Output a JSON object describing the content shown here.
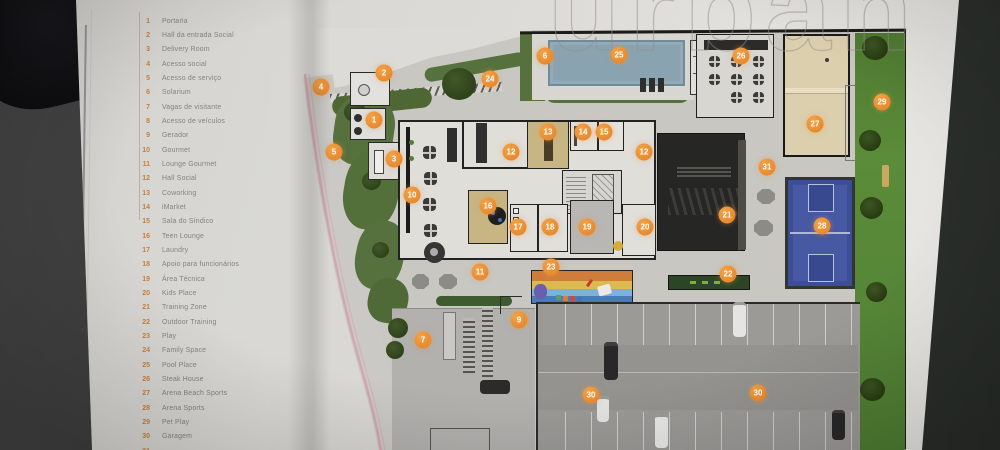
{
  "page": {
    "watermark": "urban"
  },
  "legend": {
    "items": [
      {
        "num": "1",
        "label": "Portaria"
      },
      {
        "num": "2",
        "label": "Hall da entrada Social"
      },
      {
        "num": "3",
        "label": "Delivery Room"
      },
      {
        "num": "4",
        "label": "Acesso social"
      },
      {
        "num": "5",
        "label": "Acesso de serviço"
      },
      {
        "num": "6",
        "label": "Solarium"
      },
      {
        "num": "7",
        "label": "Vagas de visitante"
      },
      {
        "num": "8",
        "label": "Acesso de veículos"
      },
      {
        "num": "9",
        "label": "Gerador"
      },
      {
        "num": "10",
        "label": "Gourmet"
      },
      {
        "num": "11",
        "label": "Lounge Gourmet"
      },
      {
        "num": "12",
        "label": "Hall Social"
      },
      {
        "num": "13",
        "label": "Coworking"
      },
      {
        "num": "14",
        "label": "iMarket"
      },
      {
        "num": "15",
        "label": "Sala do Síndico"
      },
      {
        "num": "16",
        "label": "Teen Lounge"
      },
      {
        "num": "17",
        "label": "Laundry"
      },
      {
        "num": "18",
        "label": "Apoio para funcionários"
      },
      {
        "num": "19",
        "label": "Área Técnica"
      },
      {
        "num": "20",
        "label": "Kids Place"
      },
      {
        "num": "21",
        "label": "Training Zone"
      },
      {
        "num": "22",
        "label": "Outdoor Training"
      },
      {
        "num": "23",
        "label": "Play"
      },
      {
        "num": "24",
        "label": "Family Space"
      },
      {
        "num": "25",
        "label": "Pool Place"
      },
      {
        "num": "26",
        "label": "Steak House"
      },
      {
        "num": "27",
        "label": "Arena Beach Sports"
      },
      {
        "num": "28",
        "label": "Arena Sports"
      },
      {
        "num": "29",
        "label": "Pet Play"
      },
      {
        "num": "30",
        "label": "Garagem"
      },
      {
        "num": "31",
        "label": ""
      }
    ]
  },
  "plan": {
    "markers": [
      {
        "n": "1",
        "x": 374,
        "y": 120
      },
      {
        "n": "2",
        "x": 384,
        "y": 73
      },
      {
        "n": "3",
        "x": 394,
        "y": 159
      },
      {
        "n": "4",
        "x": 321,
        "y": 87
      },
      {
        "n": "5",
        "x": 334,
        "y": 152
      },
      {
        "n": "6",
        "x": 545,
        "y": 56
      },
      {
        "n": "7",
        "x": 423,
        "y": 340
      },
      {
        "n": "9",
        "x": 519,
        "y": 320
      },
      {
        "n": "10",
        "x": 412,
        "y": 195
      },
      {
        "n": "11",
        "x": 480,
        "y": 272
      },
      {
        "n": "12",
        "x": 511,
        "y": 152
      },
      {
        "n": "12",
        "x": 644,
        "y": 152
      },
      {
        "n": "13",
        "x": 548,
        "y": 132
      },
      {
        "n": "14",
        "x": 583,
        "y": 132
      },
      {
        "n": "15",
        "x": 604,
        "y": 132
      },
      {
        "n": "16",
        "x": 488,
        "y": 206
      },
      {
        "n": "17",
        "x": 518,
        "y": 227
      },
      {
        "n": "18",
        "x": 550,
        "y": 227
      },
      {
        "n": "19",
        "x": 587,
        "y": 227
      },
      {
        "n": "20",
        "x": 645,
        "y": 227
      },
      {
        "n": "21",
        "x": 727,
        "y": 215
      },
      {
        "n": "22",
        "x": 728,
        "y": 274
      },
      {
        "n": "23",
        "x": 551,
        "y": 267
      },
      {
        "n": "24",
        "x": 490,
        "y": 79
      },
      {
        "n": "25",
        "x": 619,
        "y": 55
      },
      {
        "n": "26",
        "x": 741,
        "y": 56
      },
      {
        "n": "27",
        "x": 815,
        "y": 124
      },
      {
        "n": "28",
        "x": 822,
        "y": 226
      },
      {
        "n": "29",
        "x": 882,
        "y": 102
      },
      {
        "n": "30",
        "x": 591,
        "y": 395
      },
      {
        "n": "30",
        "x": 758,
        "y": 393
      },
      {
        "n": "31",
        "x": 767,
        "y": 167
      }
    ]
  },
  "colors": {
    "marker_orange": "#e8892f",
    "legend_number": "#c9803c",
    "legend_label": "#84837f",
    "pool_blue": "#8aa3b1",
    "court_blue": "#4659a2",
    "sand_beige": "#dccfae",
    "grass_green": "#5b8c39",
    "landscape_green": "#56713d",
    "dark_building": "#262624",
    "parking_gray": "#9b9a97",
    "page_paper": "#dcdbd7",
    "background_dark": "#343633"
  }
}
